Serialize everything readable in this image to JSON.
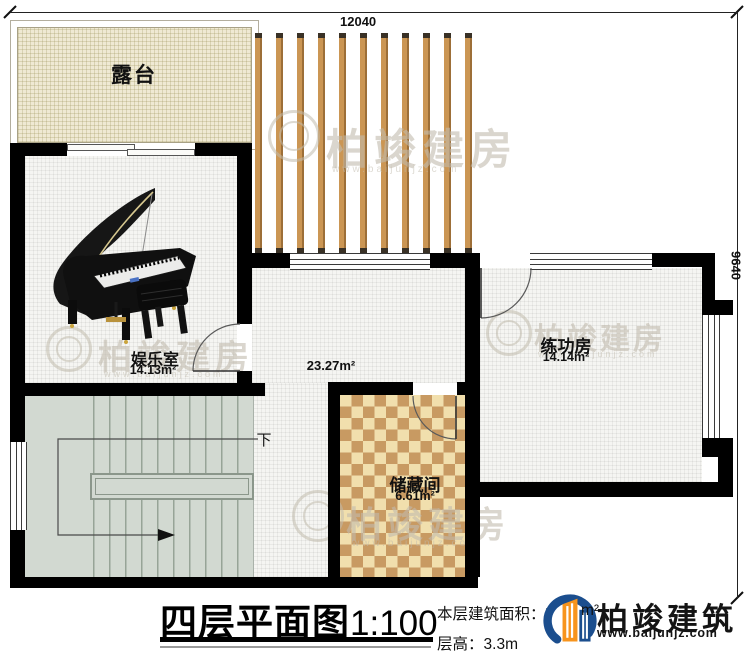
{
  "dimensions": {
    "top": "12040",
    "right": "9640"
  },
  "rooms": {
    "terrace": {
      "name": "露台"
    },
    "entertainment": {
      "name": "娱乐室",
      "area": "14.13m²"
    },
    "hall": {
      "area": "23.27m²"
    },
    "practice": {
      "name": "练功房",
      "area": "14.14m²"
    },
    "storage": {
      "name": "储藏间",
      "area": "6.61m²"
    },
    "stairs": {
      "direction": "下"
    }
  },
  "title": {
    "name": "四层平面图",
    "scale": "1:100"
  },
  "info": {
    "area_label": "本层建筑面积：",
    "area_value_visible": "7",
    "area_unit": "m²",
    "height_label": "层高：",
    "height_value": "3.3m"
  },
  "logo": {
    "company": "柏竣建筑",
    "website": "www.baijunjz.com"
  },
  "watermark": {
    "text": "柏竣建房",
    "url": "www.baijunjz.com"
  },
  "colors": {
    "wall": "#000000",
    "pergola_slat": "#cb9654",
    "checker_dark": "#c89a62",
    "checker_light": "#f1dfad",
    "stairs": "#d2d9d1",
    "terrace": "#efe9d3",
    "logo_blue": "#1b4e8e",
    "logo_orange": "#f7941d"
  }
}
